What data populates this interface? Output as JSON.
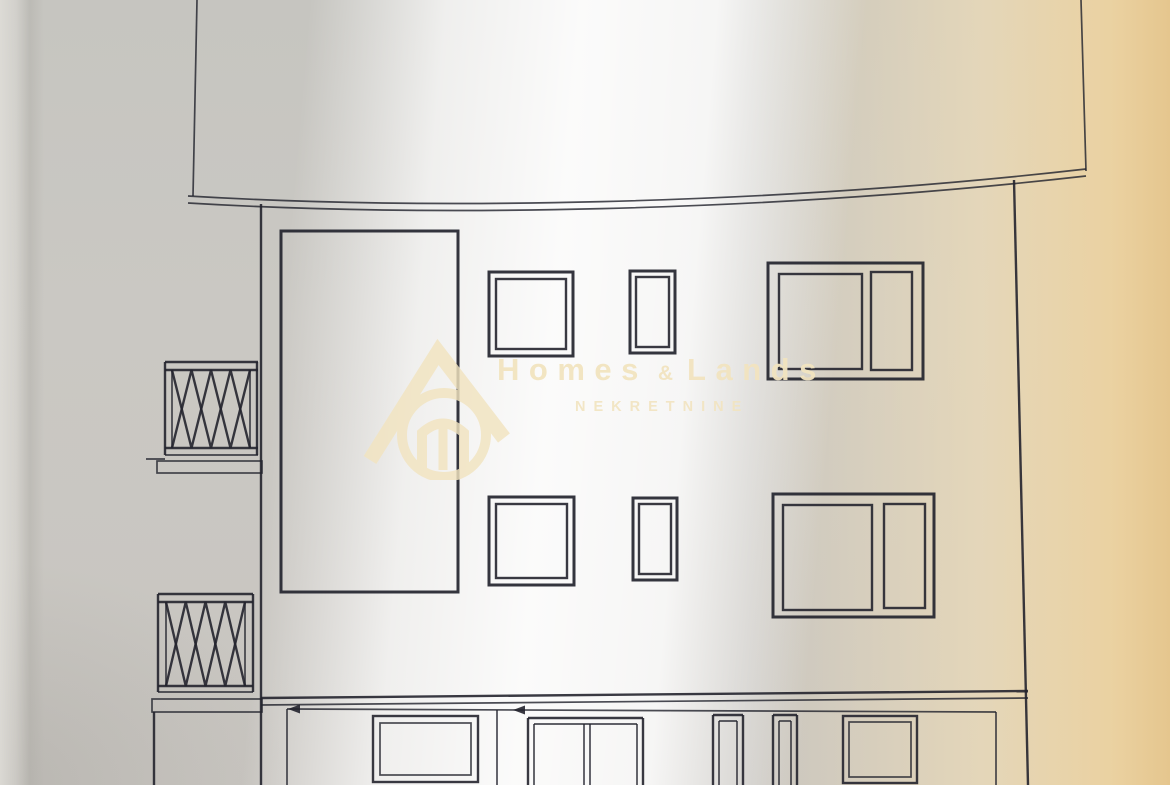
{
  "page": {
    "kind": "scanned architectural elevation drawing",
    "visible_text_only_from_watermark": true
  },
  "watermark": {
    "brand_first": "Homes",
    "brand_amp": "&",
    "brand_second": "Lands",
    "subtitle": "NEKRETNINE",
    "logo": "house-with-circle-logo",
    "color": "#f2e4c0"
  },
  "palette": {
    "line": "#23242e",
    "paper_gray": "#cac8c3",
    "paper_cream": "#eddcb8",
    "paper_tan": "#e5c68e",
    "glare": "#ffffff"
  },
  "elevation": {
    "stories_visible": 3,
    "glass_block_grid": {
      "columns": 8,
      "rows": 16
    },
    "balconies_with_lattice_railing": 2,
    "upper_floor_windows": 3,
    "middle_floor_windows": 3,
    "ground_floor_openings": 5
  }
}
